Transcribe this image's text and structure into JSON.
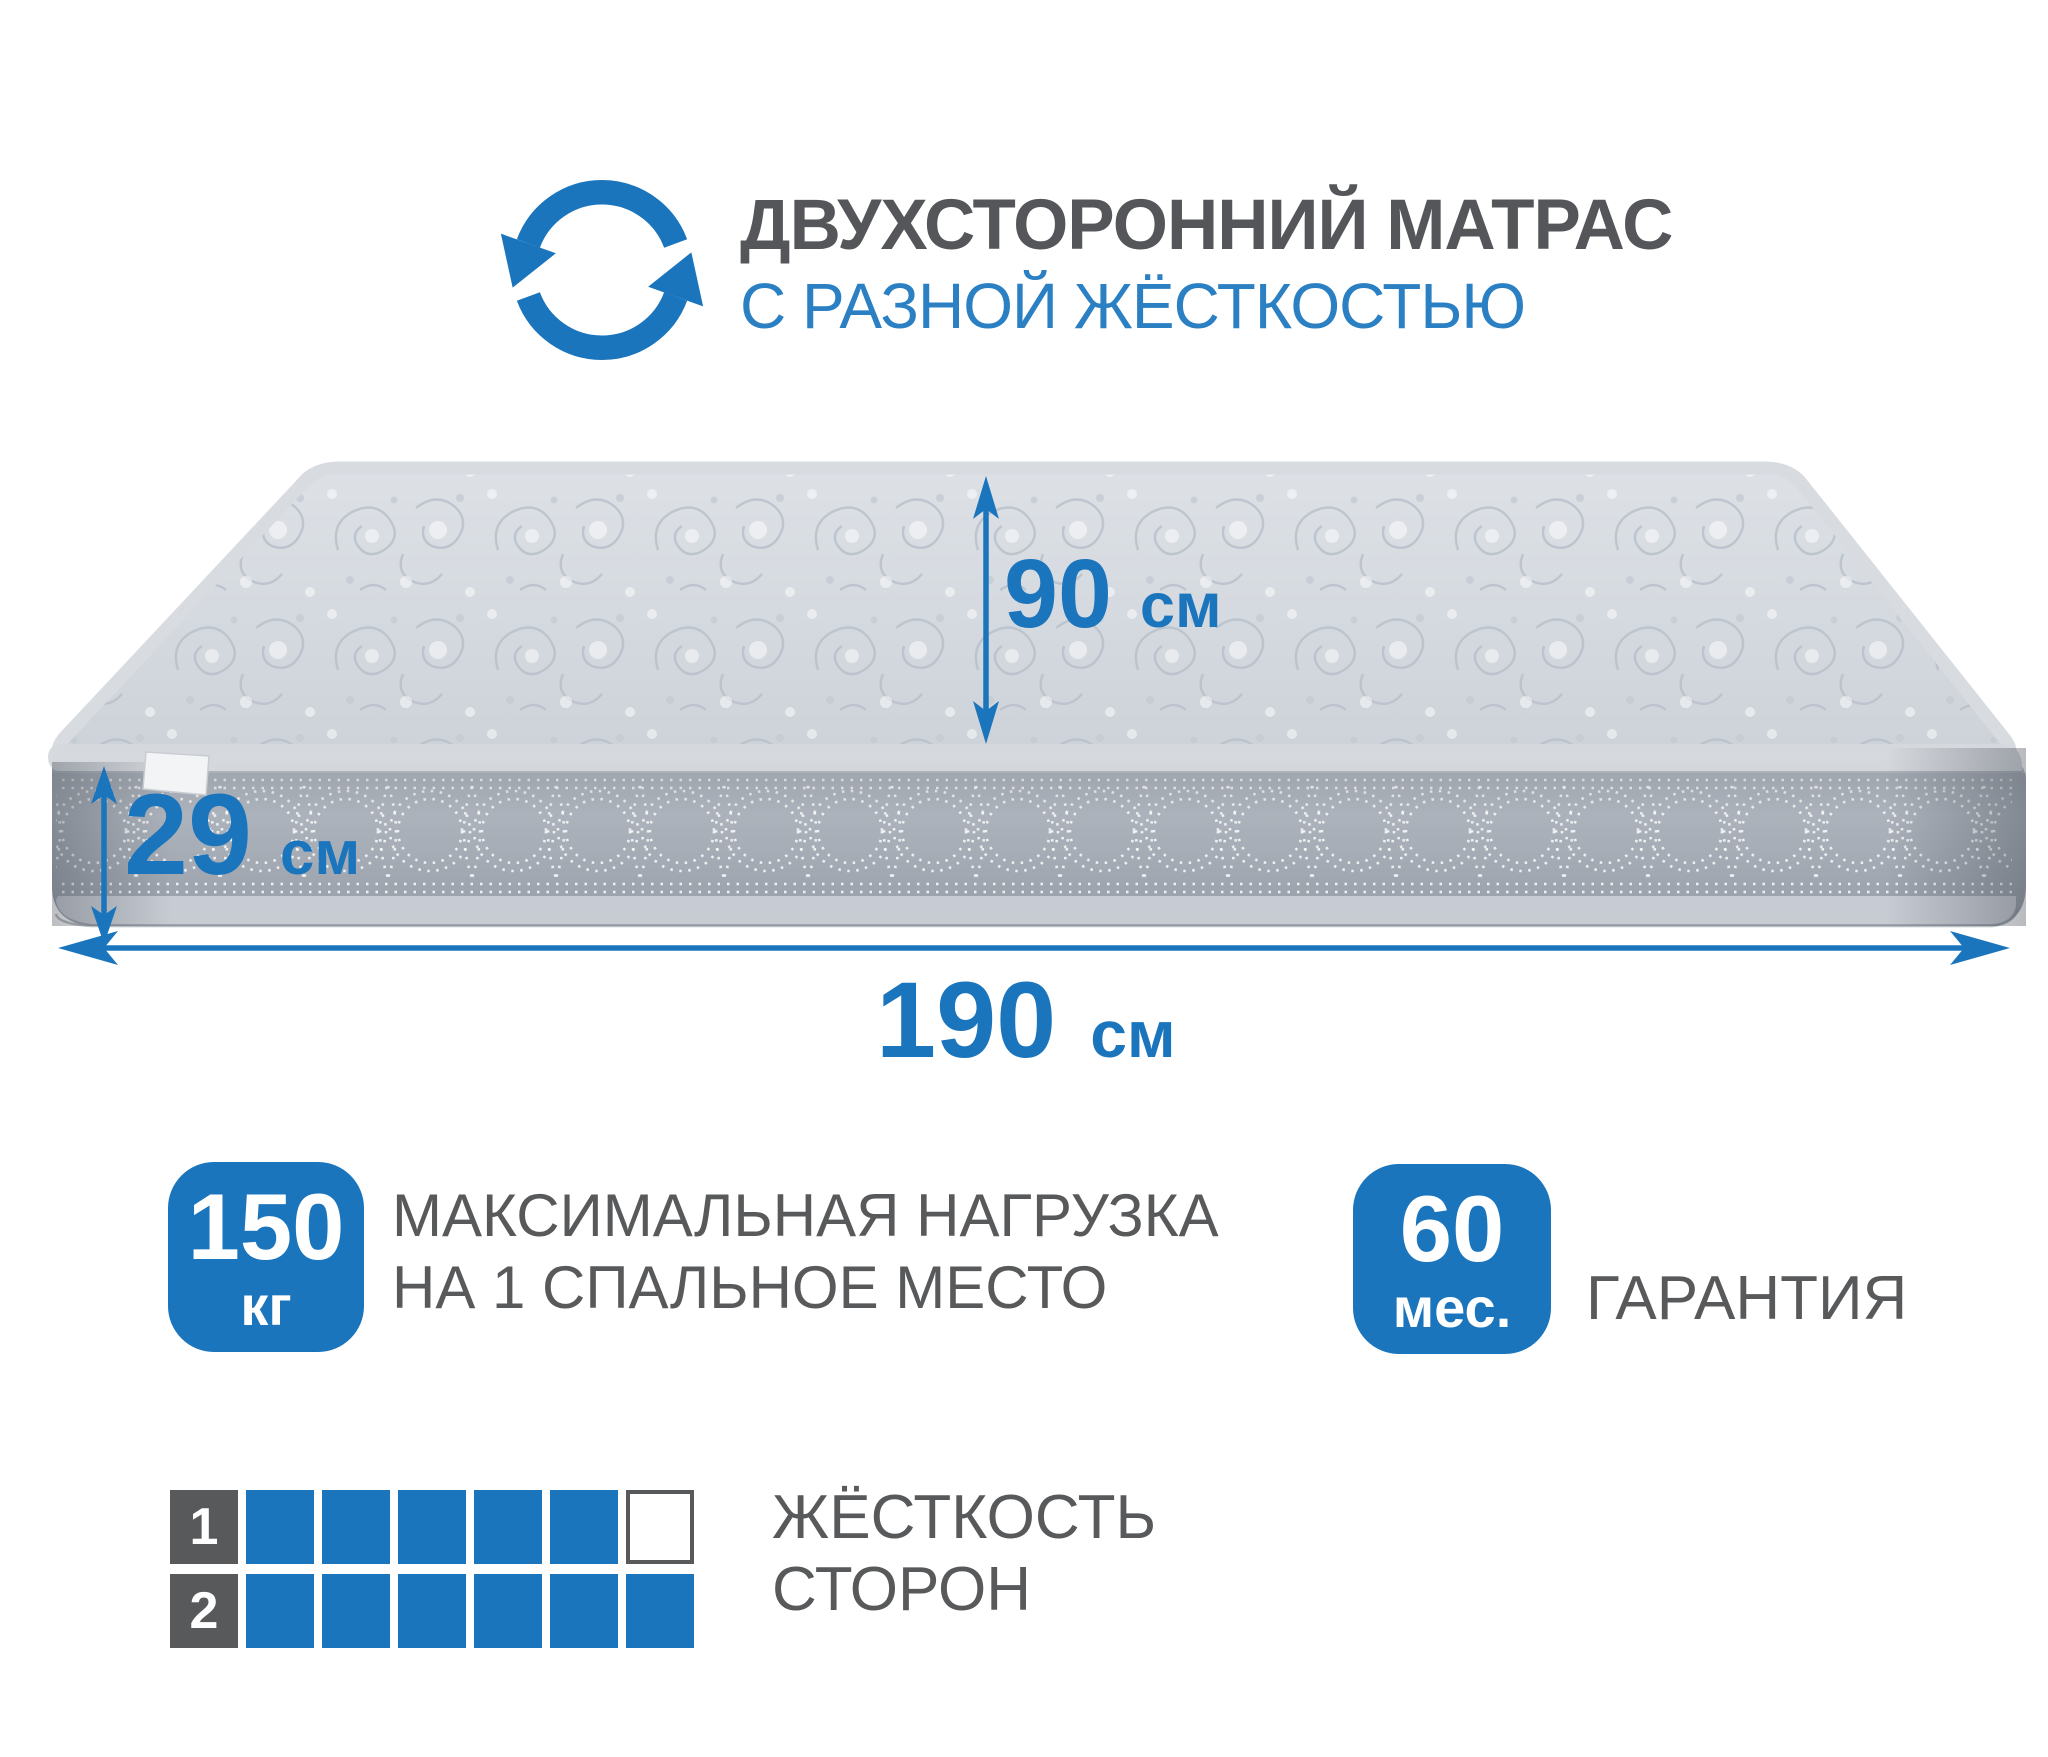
{
  "header": {
    "icon": "rotate-arrows-icon",
    "title_line1": "ДВУХСТОРОННИЙ МАТРАС",
    "title_line2": "С РАЗНОЙ ЖЁСТКОСТЬЮ"
  },
  "mattress": {
    "description": "grey quilted mattress in 3d perspective with white side tag",
    "dimensions": {
      "width": {
        "value": "90",
        "unit": "см"
      },
      "height": {
        "value": "29",
        "unit": "см"
      },
      "length": {
        "value": "190",
        "unit": "см"
      }
    }
  },
  "badges": {
    "max_load": {
      "value": "150",
      "unit": "кг",
      "description_line1": "МАКСИМАЛЬНАЯ НАГРУЗКА",
      "description_line2": "НА 1 СПАЛЬНОЕ МЕСТО"
    },
    "warranty": {
      "value": "60",
      "unit": "мес.",
      "description": "ГАРАНТИЯ"
    }
  },
  "firmness": {
    "label_line1": "ЖЁСТКОСТЬ",
    "label_line2": "СТОРОН",
    "rows": [
      {
        "side": "1",
        "filled": 5,
        "total": 6
      },
      {
        "side": "2",
        "filled": 6,
        "total": 6
      }
    ]
  },
  "colors": {
    "accent_blue": "#1b75bc",
    "title_blue": "#2b80c3",
    "text_gray": "#58595b",
    "mattress_top": "#d4d9df",
    "mattress_side": "#a5abb4"
  }
}
